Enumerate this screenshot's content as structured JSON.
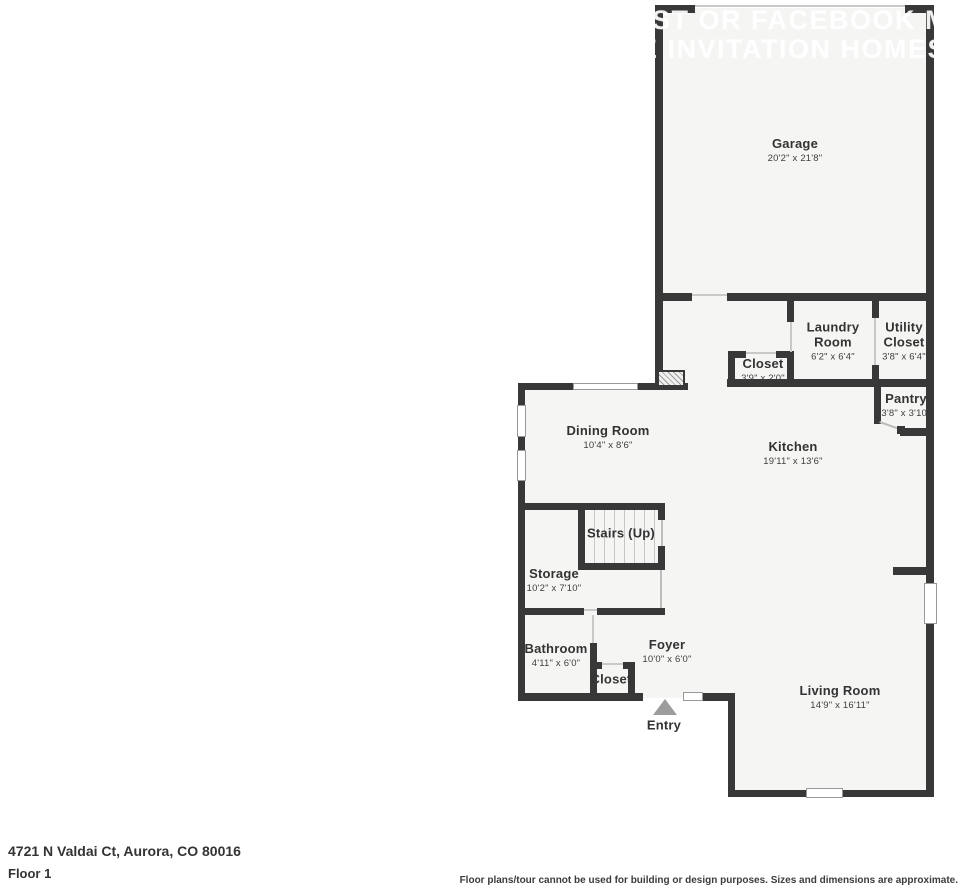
{
  "watermark": {
    "line1": "IST OR FACEBOOK MA",
    "line2": "E INVITATION HOMES W"
  },
  "rooms": {
    "garage": {
      "name": "Garage",
      "dims": "20'2\" x 21'8\""
    },
    "laundry": {
      "name": "Laundry Room",
      "dims": "6'2\" x 6'4\""
    },
    "utility": {
      "name": "Utility Closet",
      "dims": "3'8\" x 6'4\""
    },
    "closet_hall": {
      "name": "Closet",
      "dims": "3'9\" x 2'0\""
    },
    "pantry": {
      "name": "Pantry",
      "dims": "3'8\" x 3'10\""
    },
    "dining": {
      "name": "Dining Room",
      "dims": "10'4\" x 8'6\""
    },
    "kitchen": {
      "name": "Kitchen",
      "dims": "19'11\" x 13'6\""
    },
    "stairs": {
      "name": "Stairs (Up)"
    },
    "storage": {
      "name": "Storage",
      "dims": "10'2\" x 7'10\""
    },
    "bathroom": {
      "name": "Bathroom",
      "dims": "4'11\" x 6'0\""
    },
    "foyer": {
      "name": "Foyer",
      "dims": "10'0\" x 6'0\""
    },
    "closet_foyer": {
      "name": "Closet"
    },
    "living": {
      "name": "Living Room",
      "dims": "14'9\" x 16'11\""
    },
    "entry": {
      "name": "Entry"
    }
  },
  "footer": {
    "address": "4721 N Valdai Ct, Aurora, CO 80016",
    "floor": "Floor 1",
    "disclaimer": "Floor plans/tour cannot be used for building or design purposes. Sizes and dimensions are approximate."
  },
  "colors": {
    "wall": "#383838",
    "floor_fill": "#f5f5f4",
    "background": "#ffffff",
    "watermark_text": "#ffffff",
    "entry_arrow": "#9c9c9c",
    "window_outline": "#999999"
  }
}
